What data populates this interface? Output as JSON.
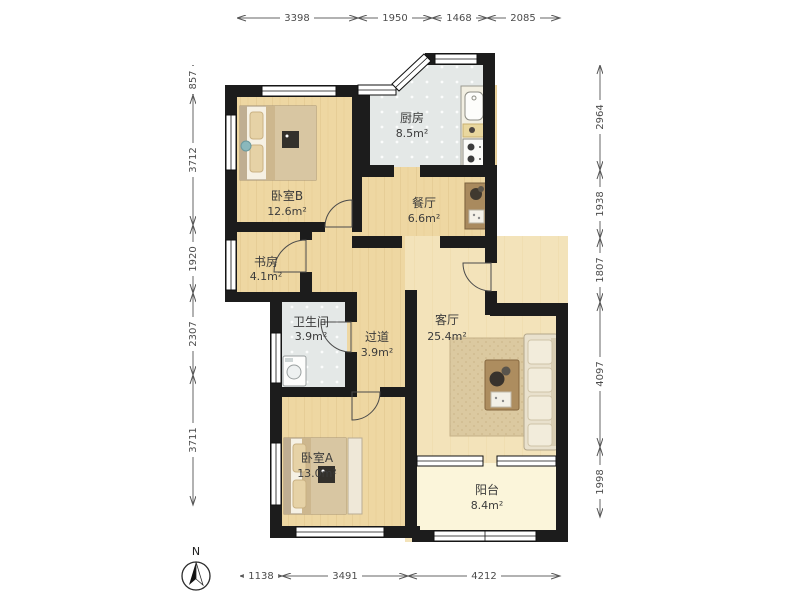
{
  "compass": {
    "north_label": "N"
  },
  "rooms": {
    "bedroomB": {
      "label": "卧室B",
      "area": "12.6m²"
    },
    "kitchen": {
      "label": "厨房",
      "area": "8.5m²"
    },
    "dining": {
      "label": "餐厅",
      "area": "6.6m²"
    },
    "study": {
      "label": "书房",
      "area": "4.1m²"
    },
    "bathroom": {
      "label": "卫生间",
      "area": "3.9m²"
    },
    "hallway": {
      "label": "过道",
      "area": "3.9m²"
    },
    "living": {
      "label": "客厅",
      "area": "25.4m²"
    },
    "bedroomA": {
      "label": "卧室A",
      "area": "13.0m²"
    },
    "balcony": {
      "label": "阳台",
      "area": "8.4m²"
    }
  },
  "dimensions_mm": {
    "top": [
      "3398",
      "1950",
      "1468",
      "2085"
    ],
    "bottom": [
      "1138",
      "3491",
      "4212"
    ],
    "left": [
      "857",
      "3712",
      "1920",
      "2307",
      "3711"
    ],
    "right": [
      "2964",
      "1938",
      "1807",
      "4097",
      "1998"
    ]
  },
  "colors": {
    "wall": "#1c1c1c",
    "wood_floor": "#eed7a2",
    "living_floor": "#f3e3ba",
    "tile_floor": "#e4e8e7",
    "balcony_floor": "#fbf5da"
  }
}
